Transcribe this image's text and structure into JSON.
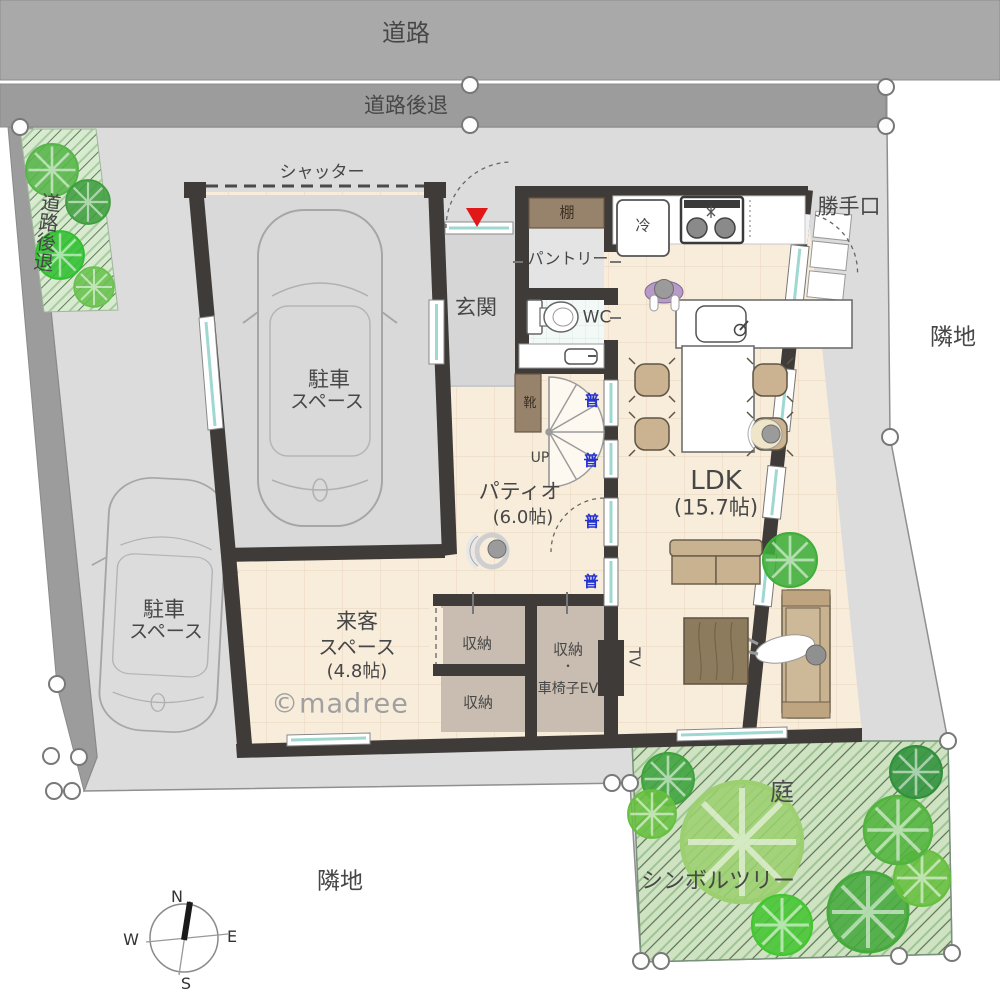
{
  "site": {
    "road_label": "道路",
    "setback_top_label": "道路後退",
    "setback_left_label": "道路後退",
    "neighbor_right_label": "隣地",
    "neighbor_bottom_label": "隣地",
    "shutter_label": "シャッター",
    "back_door_label": "勝手口",
    "garden_label": "庭",
    "symbol_tree_label": "シンボルツリー"
  },
  "rooms": {
    "garage": {
      "lines": [
        "駐車",
        "スペース"
      ]
    },
    "parking": {
      "lines": [
        "駐車",
        "スペース"
      ]
    },
    "entrance": {
      "label": "玄関"
    },
    "pantry": {
      "label": "パントリー",
      "shelf": "棚"
    },
    "wc": {
      "label": "WC"
    },
    "kitchen": {
      "fridge": "冷"
    },
    "patio": {
      "name": "パティオ",
      "size": "(6.0帖)"
    },
    "ldk": {
      "name": "LDK",
      "size": "(15.7帖)"
    },
    "guest": {
      "lines": [
        "来客",
        "スペース",
        "(4.8帖)"
      ]
    },
    "shoes": "靴",
    "stairs_up": "UP",
    "storage1": "収納",
    "storage2": "収納",
    "storage_ev": {
      "lines": [
        "収納",
        "・",
        "車椅子EV"
      ]
    },
    "tv": "TV",
    "window_mark": "普"
  },
  "compass": {
    "n": "N",
    "e": "E",
    "s": "S",
    "w": "W"
  },
  "watermark": "©madree",
  "colors": {
    "wall": "#3f3b39",
    "floor": "#f8ecdb",
    "floor_grid": "#ead9c2",
    "ground": "#dcdcdc",
    "road": "#a9a9a9",
    "setback": "#9c9c9c",
    "garden": "#cfe3c3",
    "tree_dark": "#3da23c",
    "tree_light": "#66bf3f",
    "storage": "#c8bdb0",
    "cabinet": "#97836b",
    "tan_furniture": "#c9b28f",
    "window_glass": "#9fd8d0",
    "window_mark_blue": "#2433d0",
    "entrance_marker_red": "#e01818",
    "watermark_gray": "#a0a0a0"
  }
}
